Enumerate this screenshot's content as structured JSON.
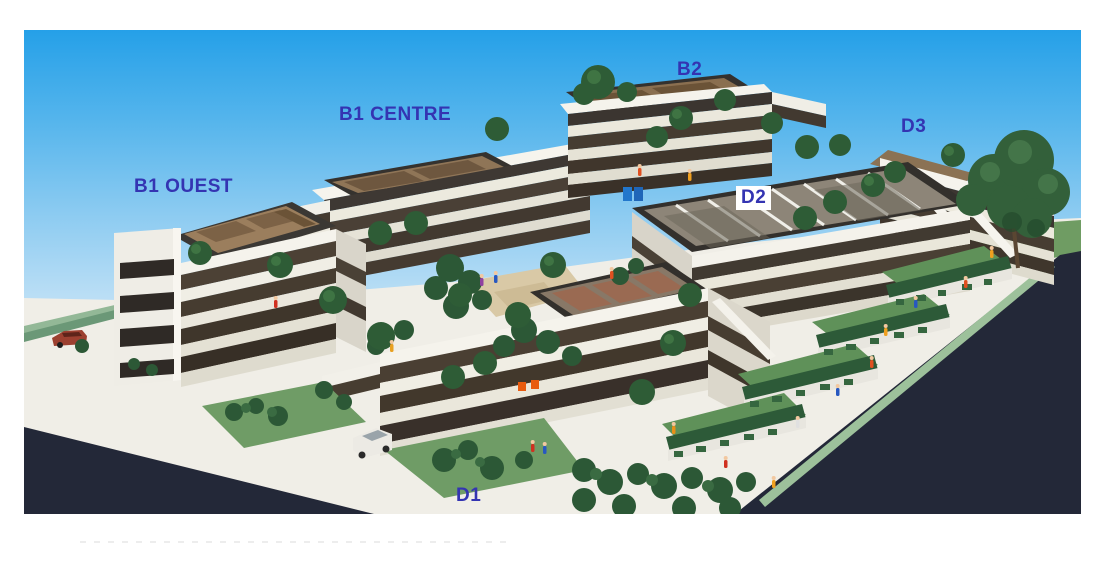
{
  "photo": {
    "description": "Aerial photograph of an architectural scale model: terraced white apartment buildings with dark window bands, brown rooftop decks, round topiary trees, lawns and hedges, miniature people, two cars, white plinth walkways and dark asphalt roads under a blue gradient sky"
  },
  "labels": {
    "b1_ouest": "B1 OUEST",
    "b1_centre": "B1 CENTRE",
    "b2": "B2",
    "d3": "D3",
    "d2": "D2",
    "d1": "D1"
  },
  "colors": {
    "label_text": "#3434b2",
    "label_d2_background": "#ffffff",
    "sky_top": "#25a0e8",
    "sky_horizon": "#eef6fb",
    "road_asphalt": "#232838",
    "model_base_white": "#f0eee7",
    "lawn_green": "#6f9c63",
    "topiary_green": "#2e5c36",
    "roof_deck_brown": "#96795a"
  }
}
